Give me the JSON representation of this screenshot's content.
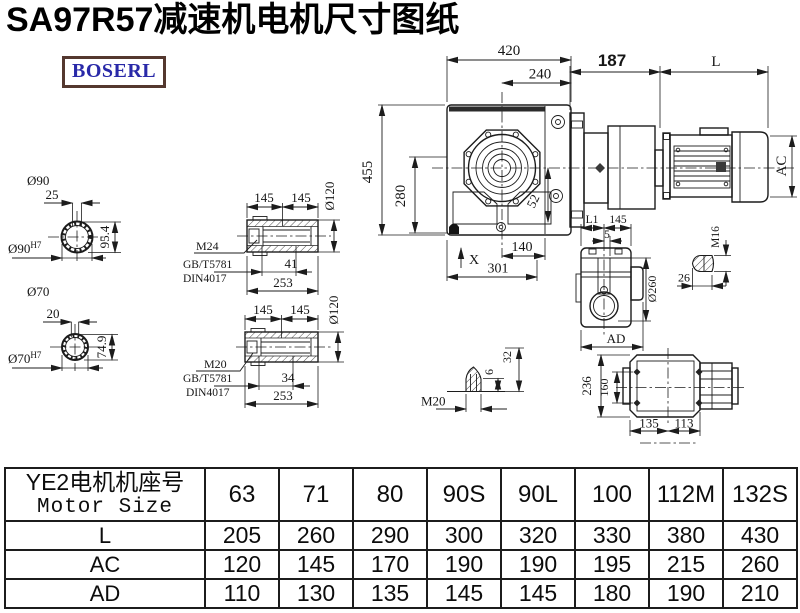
{
  "title": "SA97R57减速机电机尺寸图纸",
  "logo": "BOSERL",
  "colors": {
    "ink": "#1c1c1c",
    "logo_text": "#2929a8",
    "logo_border": "#54382f"
  },
  "drawings": {
    "front_view": {
      "width": "420",
      "width_inner": "240",
      "height": "455",
      "height_inner": "280",
      "offset": "52",
      "base": "140",
      "total_base": "301",
      "oil_mark": "X"
    },
    "motor_view": {
      "adapter_len": "187",
      "motor_len": "L",
      "motor_dia": "AC"
    },
    "shaft_90": {
      "label": "Ø90",
      "key_w": "25",
      "key_h": "95.4",
      "bore": "Ø90",
      "tol": "H7"
    },
    "shaft_70": {
      "label": "Ø70",
      "key_w": "20",
      "key_h": "74.9",
      "bore": "Ø70",
      "tol": "H7"
    },
    "hollow_m24": {
      "seg1": "145",
      "seg2": "145",
      "dia": "Ø120",
      "thread": "M24",
      "std1": "GB/T5781",
      "std2": "DIN4017",
      "depth": "41",
      "length": "253"
    },
    "hollow_m20": {
      "seg1": "145",
      "seg2": "145",
      "dia": "Ø120",
      "thread": "M20",
      "std1": "GB/T5781",
      "std2": "DIN4017",
      "depth": "34",
      "length": "253"
    },
    "side_view": {
      "l1": "L1",
      "len": "145",
      "step": "5",
      "dia": "Ø260",
      "ad": "AD"
    },
    "stud_m16": {
      "thread": "M16",
      "len": "26"
    },
    "top_view": {
      "height": "236",
      "bolt_span": "160",
      "left": "135",
      "right": "113"
    },
    "stud_m20": {
      "thread": "M20",
      "step": "6",
      "height": "32"
    }
  },
  "table": {
    "header_cn": "YE2电机机座号",
    "header_en": "Motor Size",
    "columns": [
      "63",
      "71",
      "80",
      "90S",
      "90L",
      "100",
      "112M",
      "132S"
    ],
    "rows": [
      {
        "label": "L",
        "values": [
          "205",
          "260",
          "290",
          "300",
          "320",
          "330",
          "380",
          "430"
        ]
      },
      {
        "label": "AC",
        "values": [
          "120",
          "145",
          "170",
          "190",
          "190",
          "195",
          "215",
          "260"
        ]
      },
      {
        "label": "AD",
        "values": [
          "110",
          "130",
          "135",
          "145",
          "145",
          "180",
          "190",
          "210"
        ]
      }
    ]
  }
}
